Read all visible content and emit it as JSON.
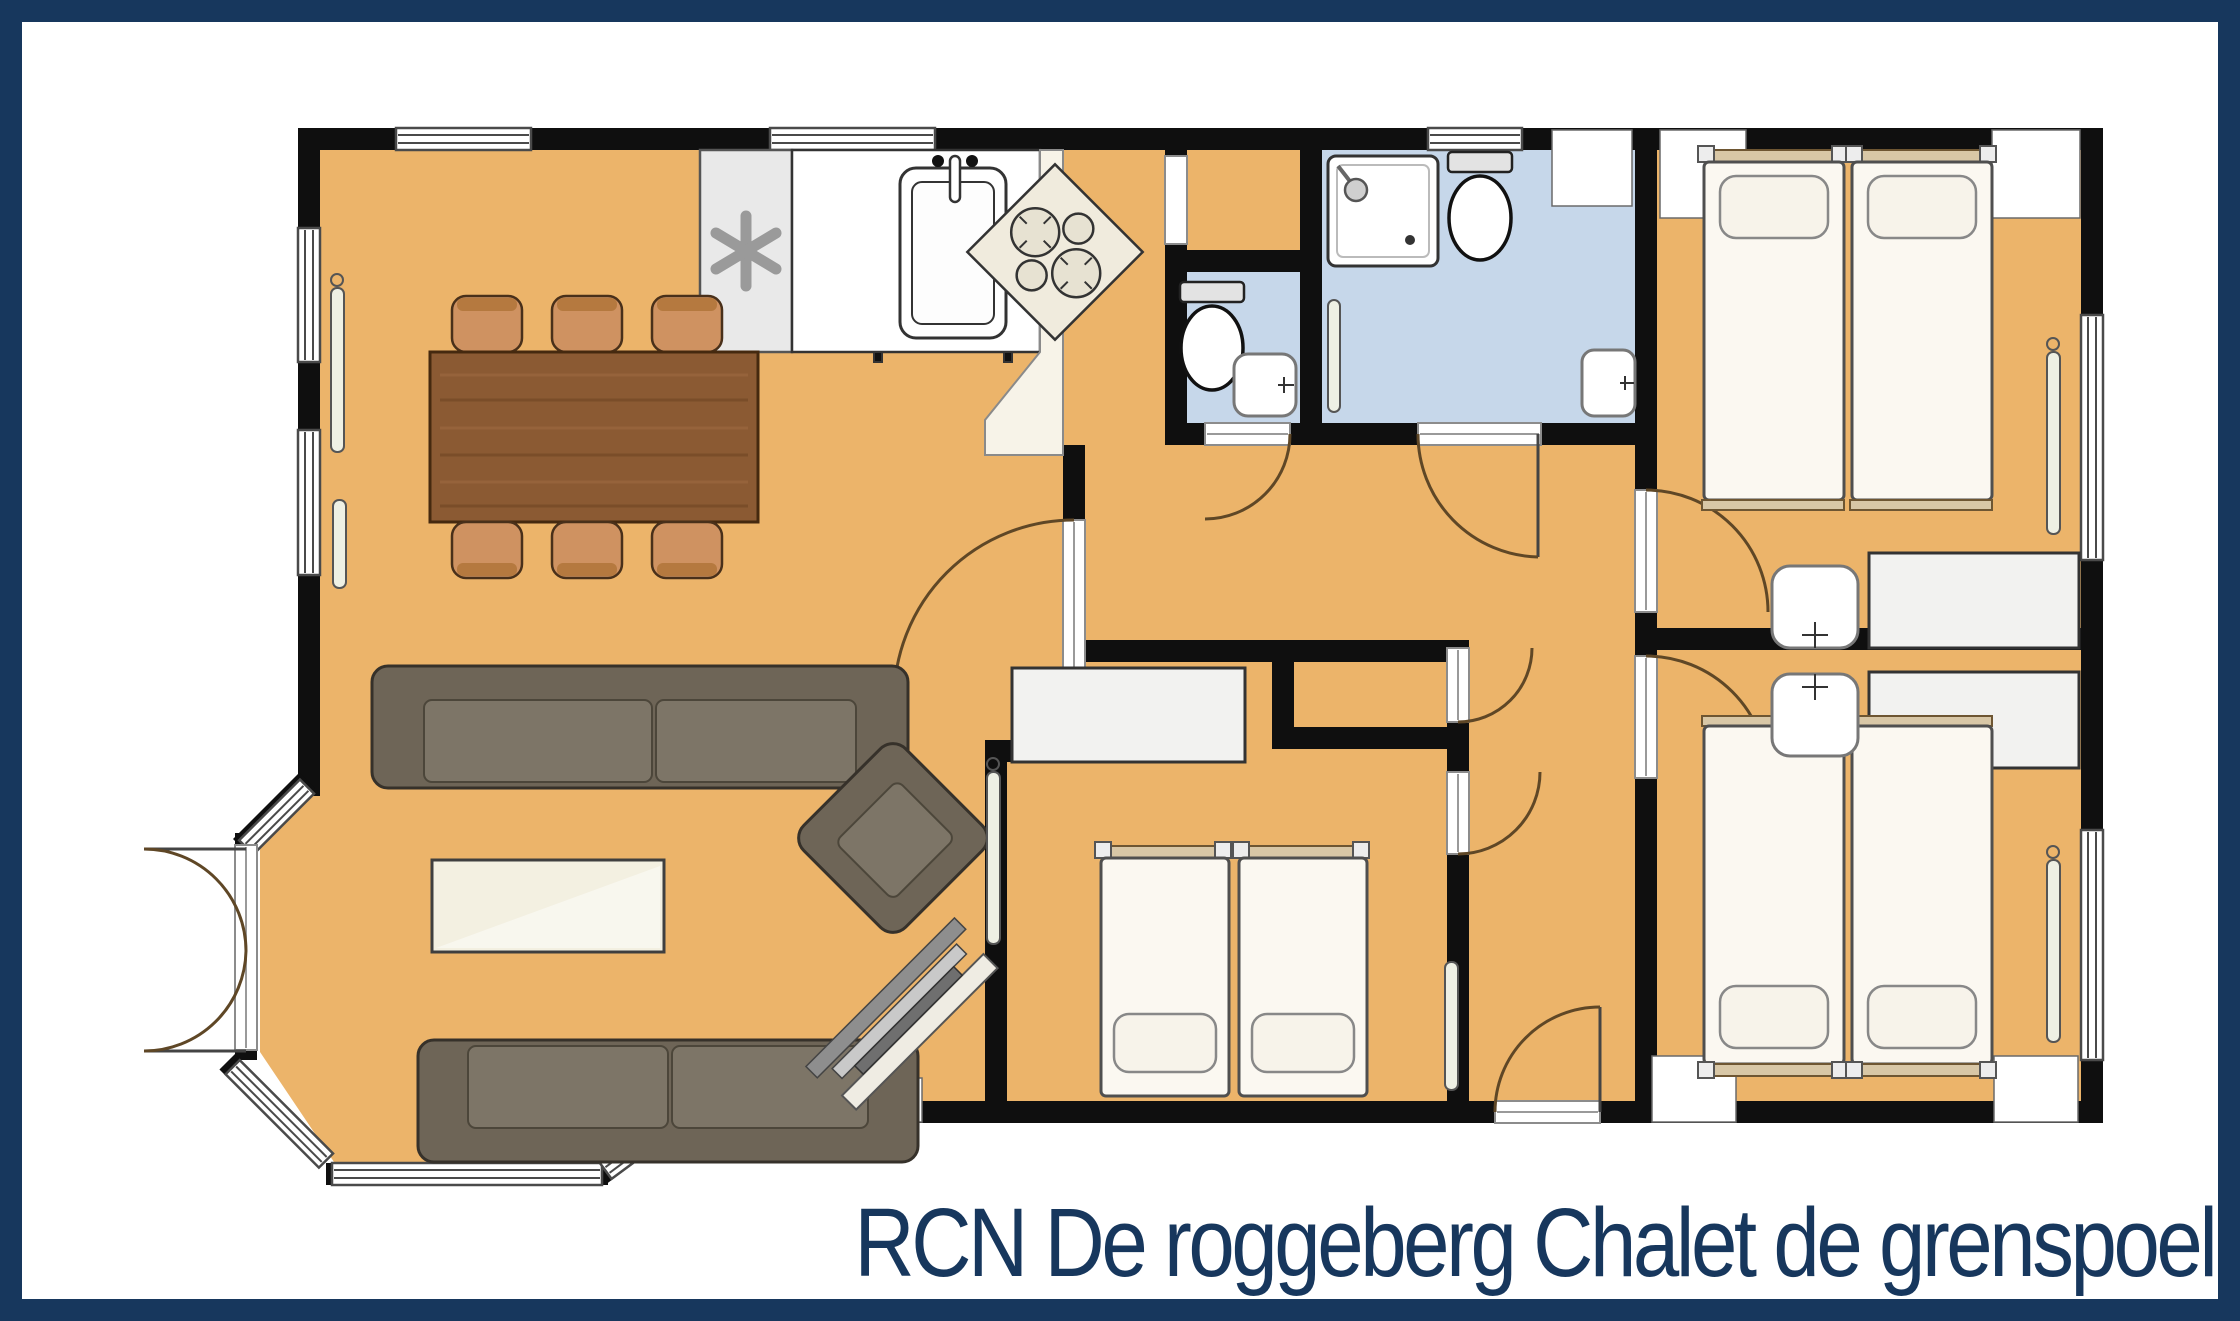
{
  "title": "RCN De roggeberg Chalet de grenspoel",
  "colors": {
    "frame": "#17375d",
    "background": "#ffffff",
    "wall": "#0f0f0f",
    "floor": "#ecb46a",
    "wet_floor": "#c6d7ea",
    "counter": "#f7f3e8",
    "wood": "#8b5a33",
    "chair": "#cf9261",
    "sofa": "#6e6557",
    "mattress": "#fbf8f1",
    "wardrobe": "#f2f2f0",
    "coffee_table": "#f3f0e1",
    "radiator": "#eef0e4",
    "window_line": "#4a4a4a"
  },
  "plan": {
    "type": "floor-plan",
    "rooms": [
      {
        "name": "living-dining-room",
        "floor": "orange",
        "features": [
          "bay-window",
          "french-doors"
        ]
      },
      {
        "name": "kitchen",
        "floor": "orange",
        "features": [
          "l-shaped-counter",
          "corner-stove"
        ]
      },
      {
        "name": "storage-closet",
        "floor": "orange"
      },
      {
        "name": "toilet-room",
        "floor": "blue"
      },
      {
        "name": "bathroom",
        "floor": "blue",
        "features": [
          "shower",
          "toilet",
          "washbasin"
        ]
      },
      {
        "name": "hallway",
        "floor": "orange"
      },
      {
        "name": "bedroom-top-right",
        "floor": "orange",
        "beds": 2
      },
      {
        "name": "bedroom-bottom-right",
        "floor": "orange",
        "beds": 2
      },
      {
        "name": "bedroom-middle",
        "floor": "orange",
        "beds": 2
      }
    ],
    "furniture": {
      "dining_table": 1,
      "dining_chairs": 6,
      "sofas": 2,
      "armchair": 1,
      "coffee_table": 1,
      "tv_cabinet": 1,
      "beds": 6,
      "wardrobes": 3,
      "washbasins": 4,
      "toilets": 2,
      "shower_tray": 1,
      "kitchen_sink": 1,
      "stove": 1,
      "fridge_freezer": 1,
      "radiators": 6,
      "exterior_doors": 2
    }
  }
}
